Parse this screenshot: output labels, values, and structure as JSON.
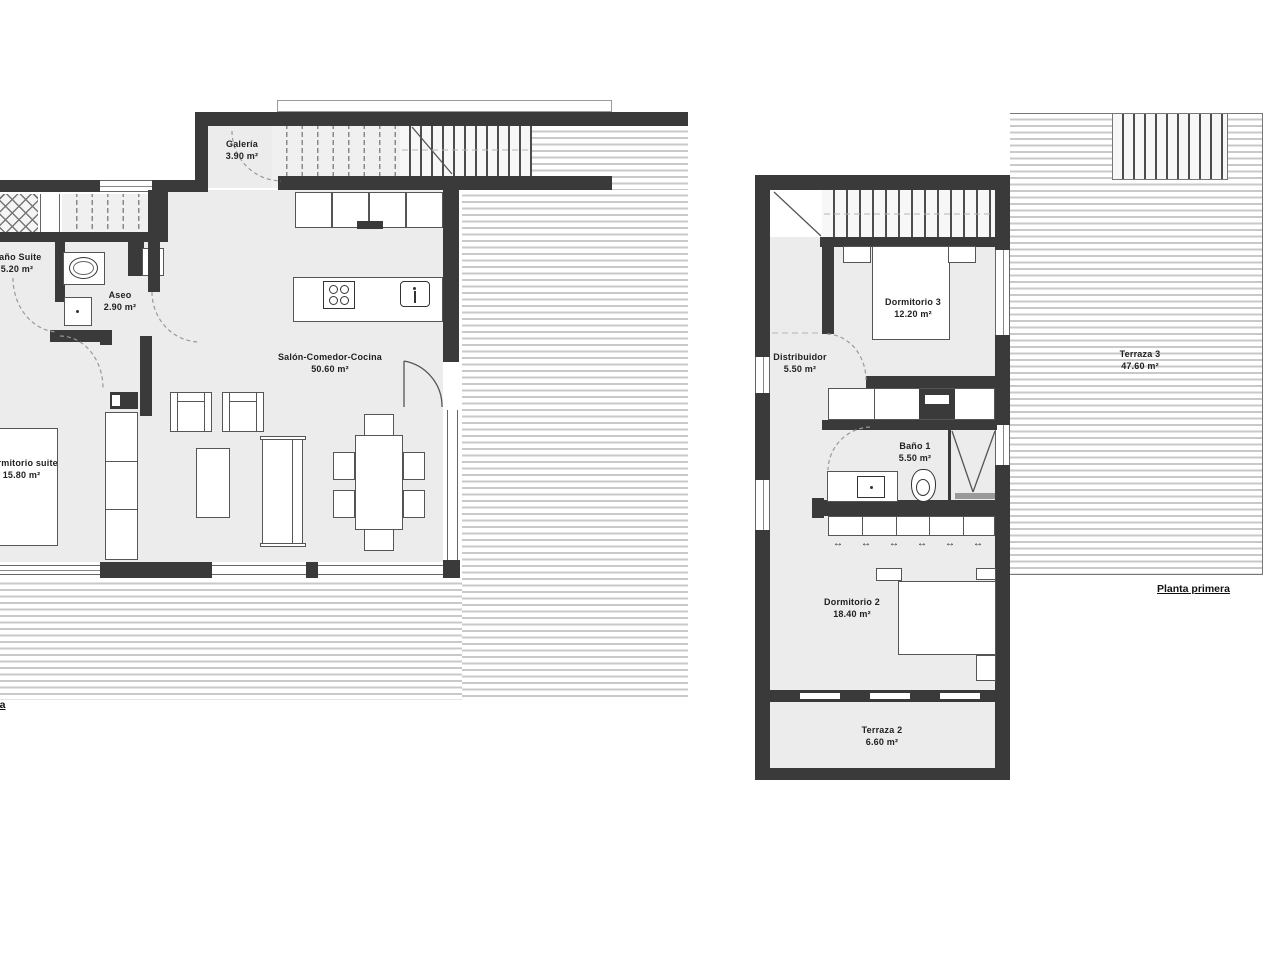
{
  "page": {
    "type": "architectural floor plan drawing",
    "background": "#ffffff"
  },
  "colors": {
    "wall": "#3a3a3a",
    "floor": "#ececec",
    "deck_stripe": "#c9c9c9",
    "furniture_line": "#555555",
    "label_text": "#222222",
    "door_arc": "#999999"
  },
  "plans": [
    {
      "id": "planta-baja",
      "title": "Planta baja",
      "rooms": [
        {
          "name": "Baño Suite",
          "area": "5.20 m²"
        },
        {
          "name": "Aseo",
          "area": "2.90 m²"
        },
        {
          "name": "Galería",
          "area": "3.90 m²"
        },
        {
          "name": "Salón-Comedor-Cocina",
          "area": "50.60 m²"
        },
        {
          "name": "Dormitorio suite",
          "area": "15.80 m²"
        }
      ]
    },
    {
      "id": "planta-primera",
      "title": "Planta primera",
      "rooms": [
        {
          "name": "Dormitorio 3",
          "area": "12.20 m²"
        },
        {
          "name": "Distribuidor",
          "area": "5.50 m²"
        },
        {
          "name": "Baño 1",
          "area": "5.50 m²"
        },
        {
          "name": "Terraza 3",
          "area": "47.60 m²"
        },
        {
          "name": "Dormitorio 2",
          "area": "18.40 m²"
        },
        {
          "name": "Terraza 2",
          "area": "6.60 m²"
        }
      ]
    }
  ],
  "symbols": {
    "sliding_door_arrow": "↔"
  }
}
